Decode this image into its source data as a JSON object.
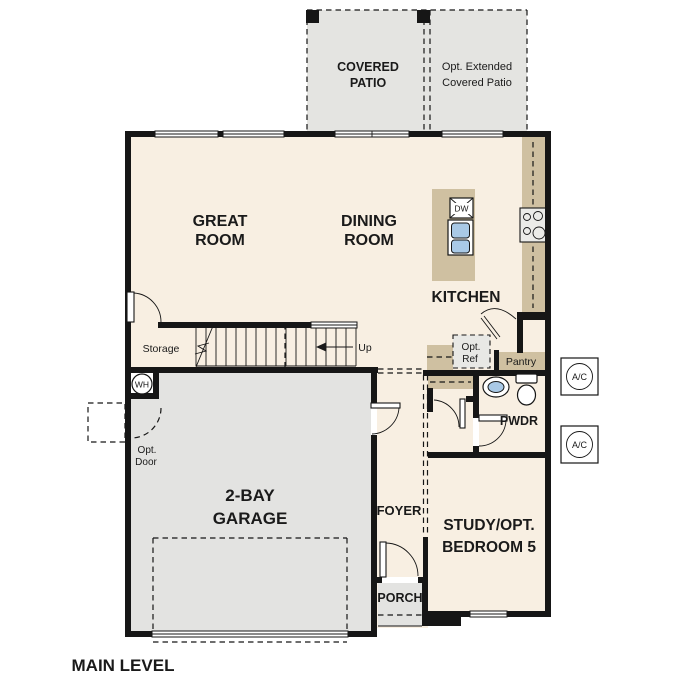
{
  "title": "MAIN LEVEL",
  "colors": {
    "wall": "#161616",
    "floor": "#f8efe2",
    "garage": "#e3e3e1",
    "patio": "#e4e4e1",
    "counter": "#cfc0a1",
    "blue": "#a9c9e6",
    "optref": "#e8e8e5",
    "appl": "#ebebe8"
  },
  "labels": {
    "covered_patio": {
      "line1": "COVERED",
      "line2": "PATIO"
    },
    "ext_patio": {
      "line1": "Opt. Extended",
      "line2": "Covered Patio"
    },
    "great_room": {
      "line1": "GREAT",
      "line2": "ROOM"
    },
    "dining_room": {
      "line1": "DINING",
      "line2": "ROOM"
    },
    "kitchen": "KITCHEN",
    "storage": "Storage",
    "up": "Up",
    "pantry": "Pantry",
    "opt_ref": {
      "line1": "Opt.",
      "line2": "Ref"
    },
    "opt_door": {
      "line1": "Opt.",
      "line2": "Door"
    },
    "wh": "WH",
    "dw": "DW",
    "ac": "A/C",
    "foyer": "FOYER",
    "porch": "PORCH",
    "pwdr": "PWDR",
    "study": {
      "line1": "STUDY/OPT.",
      "line2": "BEDROOM 5"
    },
    "garage": {
      "line1": "2-BAY",
      "line2": "GARAGE"
    }
  }
}
